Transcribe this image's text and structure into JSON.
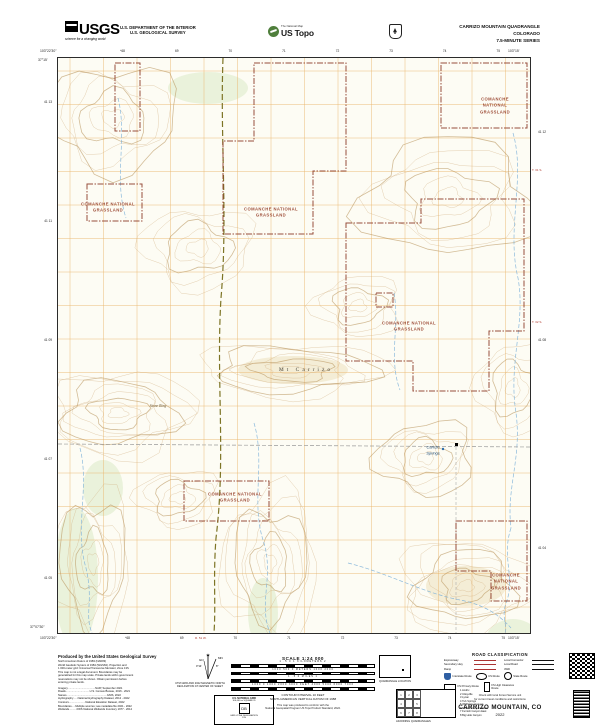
{
  "header": {
    "usgs": "USGS",
    "usgs_tagline": "science for a changing world",
    "dept_line1": "U.S. DEPARTMENT OF THE INTERIOR",
    "dept_line2": "U.S. GEOLOGICAL SURVEY",
    "natmap": "The National Map",
    "ustopo": "US Topo",
    "quad_title": "CARRIZO MOUNTAIN QUADRANGLE",
    "state": "COLORADO",
    "series": "7.5-MINUTE SERIES"
  },
  "collar": {
    "nw_lon": "103°22'30\"",
    "ne_lon": "103°15'",
    "nw_lat": "37°15'",
    "sw_lat": "37°07'30\"",
    "sw_lon": "103°22'30\"",
    "se_lon": "103°15'",
    "top_ticks": [
      "⁴68",
      "69",
      "70",
      "71",
      "72",
      "73",
      "74",
      "75"
    ],
    "bottom_ticks": [
      "⁴68",
      "69",
      "70",
      "71",
      "72",
      "73",
      "74",
      "75"
    ],
    "left_ticks": [
      "41 13",
      "41 11",
      "41 09",
      "41 07",
      "41 05"
    ],
    "right_ticks": [
      "41 12",
      "41 08",
      "41 04"
    ],
    "township_1": "T. 31 S.",
    "township_2": "T. 32 S.",
    "range_label": "R. 51 W."
  },
  "map": {
    "labels": {
      "grassland_line1": "COMANCHE NATIONAL",
      "grassland_line2": "GRASSLAND",
      "mt_carrizo": "Mt Carrizo",
      "springs_line1": "Carrizo",
      "springs_line2": "Springs",
      "stone": "Stone Ring"
    }
  },
  "footer": {
    "produced_by": "Produced by the United States Geological Survey",
    "datum_lines": [
      "North American Datum of 1983 (NAD83)",
      "World Geodetic System of 1984 (WGS84). Projection and",
      "1 000-meter grid: Universal Transverse Mercator, Zone 13S",
      "This map is not a legal document. Boundaries may be",
      "generalized for this map scale. Private lands within government",
      "reservations may not be shown. Obtain permission before",
      "entering private lands."
    ],
    "credit_lines": [
      "Imagery.....................................NAIP, September 2021",
      "Roads................................U.S. Census Bureau, 2016 - 2021",
      "Names......................................................GNIS, 2022",
      "Hydrography......National Hydrography Dataset, 2012 - 2022",
      "Contours......................National Elevation Dataset, 2022",
      "Boundaries.....Multiple sources; see metadata file 2021 - 2022",
      "Wetlands..........FWS National Wetlands Inventory 1977 - 2014"
    ],
    "declination": {
      "caption1": "UTM GRID AND 2022 MAGNETIC NORTH",
      "caption2": "DECLINATION AT CENTER OF SHEET",
      "gn": "GN",
      "mn": "MN",
      "gn_angle": "0°14'",
      "mn_angle": "8°"
    },
    "usng": {
      "title": "U.S. NATIONAL GRID",
      "sub": "100,000-m SQUARE ID",
      "square_id": "DB",
      "zone_label": "GRID ZONE DESIGNATION",
      "zone": "13S"
    },
    "scale": {
      "title": "SCALE 1:24 000",
      "bars": [
        {
          "ticks": "1    .5    0    1    KILOMETERS    2"
        },
        {
          "ticks": "1000    500    0    METERS    1000    2000"
        },
        {
          "ticks": "1    .5    0    MILES    1"
        },
        {
          "ticks": "1000  0  1000  2000  3000  FEET  4000  5000  6000  7000"
        }
      ],
      "contour1": "CONTOUR INTERVAL 10 FEET",
      "contour2": "NORTH AMERICAN VERTICAL DATUM OF 1988",
      "standard1": "This map was produced to conform with the",
      "standard2": "National Geospatial Program US Topo Product Standard, 2022."
    },
    "quad_location_caption": "QUADRANGLE LOCATION",
    "adjoining": {
      "caption": "ADJOINING QUADRANGLES",
      "cells": [
        "1",
        "2",
        "3",
        "4",
        "",
        "5",
        "6",
        "7",
        "8"
      ],
      "list": [
        "1 Andrix",
        "2 Utleyville",
        "3 Lycan",
        "4 Tub Springs",
        "5 Wildhorse Canyon",
        "6 Furnish Canyon West",
        "7 Furnish Canyon East",
        "8 Big Hole Canyon"
      ]
    },
    "road_classification": {
      "title": "ROAD CLASSIFICATION",
      "rows": [
        {
          "left": "Expressway",
          "right": "Local Connector"
        },
        {
          "left": "Secondary Hwy",
          "right": "Local Road"
        },
        {
          "left": "Ramp",
          "right": "4WD"
        }
      ],
      "interstate": "Interstate Route",
      "us_route": "US Route",
      "state_route": "State Route",
      "fs_primary": "FS Primary Route",
      "fs_high": "FS High Clearance Route",
      "note1": "Check with local Forest Service unit",
      "note2": "for current travel conditions and restrictions"
    },
    "map_name": "CARRIZO MOUNTAIN, CO",
    "year": "2022"
  }
}
